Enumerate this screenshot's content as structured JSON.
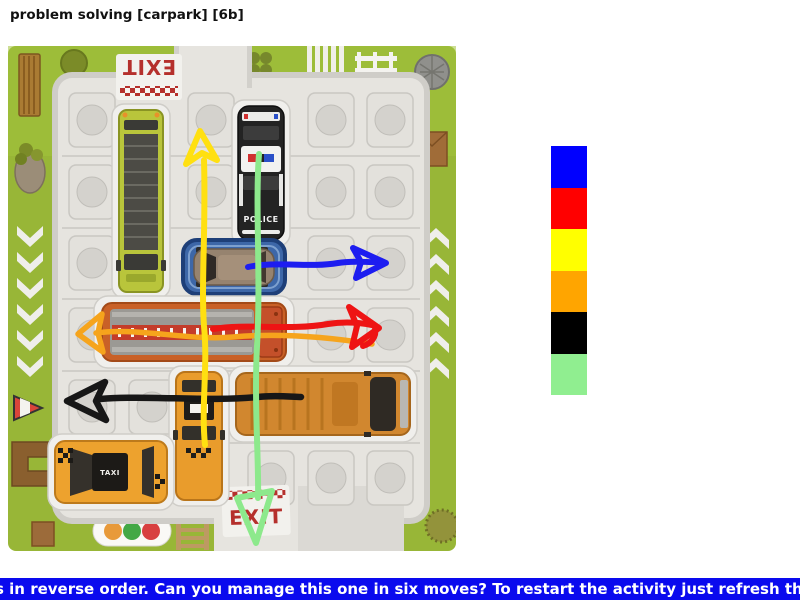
{
  "page": {
    "title": "problem solving [carpark] [6b]"
  },
  "photo": {
    "description": "photograph of a carpark sliding-block puzzle board with six marker arrows drawn on it",
    "board": {
      "exit_top_label": "EXIT",
      "exit_bottom_label": "EXIT",
      "police_label": "POLICE",
      "taxi_label": "TAXI"
    },
    "vehicles": [
      {
        "name": "lime-bus",
        "orientation": "vertical",
        "color": "#b9c53b"
      },
      {
        "name": "police-car",
        "orientation": "vertical",
        "color": "#232323"
      },
      {
        "name": "grey-car-on-blue-card",
        "orientation": "horizontal",
        "color": "#96836f"
      },
      {
        "name": "fire-truck",
        "orientation": "horizontal",
        "color": "#c96127"
      },
      {
        "name": "school-bus",
        "orientation": "horizontal",
        "color": "#d1872f"
      },
      {
        "name": "taxi-vertical",
        "orientation": "vertical",
        "color": "#e99c2c"
      },
      {
        "name": "taxi-horizontal",
        "orientation": "horizontal",
        "color": "#eda22e"
      }
    ],
    "arrows": [
      {
        "name": "yellow-arrow-up",
        "direction": "up",
        "color": "#ffe011"
      },
      {
        "name": "green-arrow-down",
        "direction": "down",
        "color": "#8de98c"
      },
      {
        "name": "blue-arrow-right",
        "direction": "right",
        "color": "#1d1df0"
      },
      {
        "name": "red-arrow-right",
        "direction": "right",
        "color": "#ee1414"
      },
      {
        "name": "orange-arrow-left",
        "direction": "left",
        "color": "#f6a41c"
      },
      {
        "name": "black-arrow-left",
        "direction": "left",
        "color": "#171717"
      }
    ]
  },
  "palette": {
    "swatches": [
      {
        "name": "blue",
        "color": "#0000ff"
      },
      {
        "name": "red",
        "color": "#ff0000"
      },
      {
        "name": "yellow",
        "color": "#ffff00"
      },
      {
        "name": "orange",
        "color": "#ffa500"
      },
      {
        "name": "black",
        "color": "#000000"
      },
      {
        "name": "green",
        "color": "#90ee90"
      }
    ]
  },
  "footer": {
    "text": "s in reverse order. Can you manage this one in six moves? To restart the activity just refresh the pag",
    "background": "#0a0aee",
    "color": "#ffffff"
  }
}
